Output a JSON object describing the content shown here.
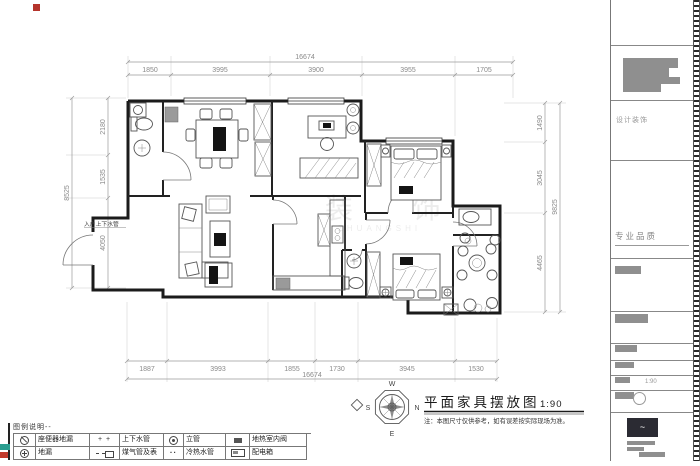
{
  "drawing": {
    "title": "平面家具摆放图",
    "scale": "1:90",
    "note": "注：本图尺寸仅供参考，如有误差按实际现场为准。",
    "entry_label": "入户上下水管",
    "watermark_cn": "装 饰",
    "watermark_en": "ZHUANGSHI",
    "compass": {
      "n": "N",
      "e": "E",
      "s": "S",
      "w": "W"
    }
  },
  "dimensions": {
    "top": {
      "total": "16674",
      "segments": [
        "1850",
        "3995",
        "3900",
        "3955",
        "1705"
      ]
    },
    "bottom": {
      "total": "16674",
      "segments": [
        "1887",
        "3993",
        "1855",
        "1730",
        "3945",
        "1530"
      ]
    },
    "left": {
      "total": "8525",
      "segments": [
        "2180",
        "1535",
        "4050"
      ]
    },
    "right": {
      "total": "9825",
      "segments": [
        "1490",
        "3045",
        "4465"
      ]
    }
  },
  "legend": {
    "header": "图例说明--",
    "items": [
      {
        "label": "座便器地漏"
      },
      {
        "label": "上下水管"
      },
      {
        "label": "立管"
      },
      {
        "label": "地热室内阀"
      },
      {
        "label": "地漏"
      },
      {
        "label": "煤气管及表"
      },
      {
        "label": "冷热水管"
      },
      {
        "label": "配电箱"
      }
    ]
  },
  "sidebar": {
    "design_label": "设计装饰",
    "quality_label": "专业品质",
    "scale_label": "1:90"
  }
}
